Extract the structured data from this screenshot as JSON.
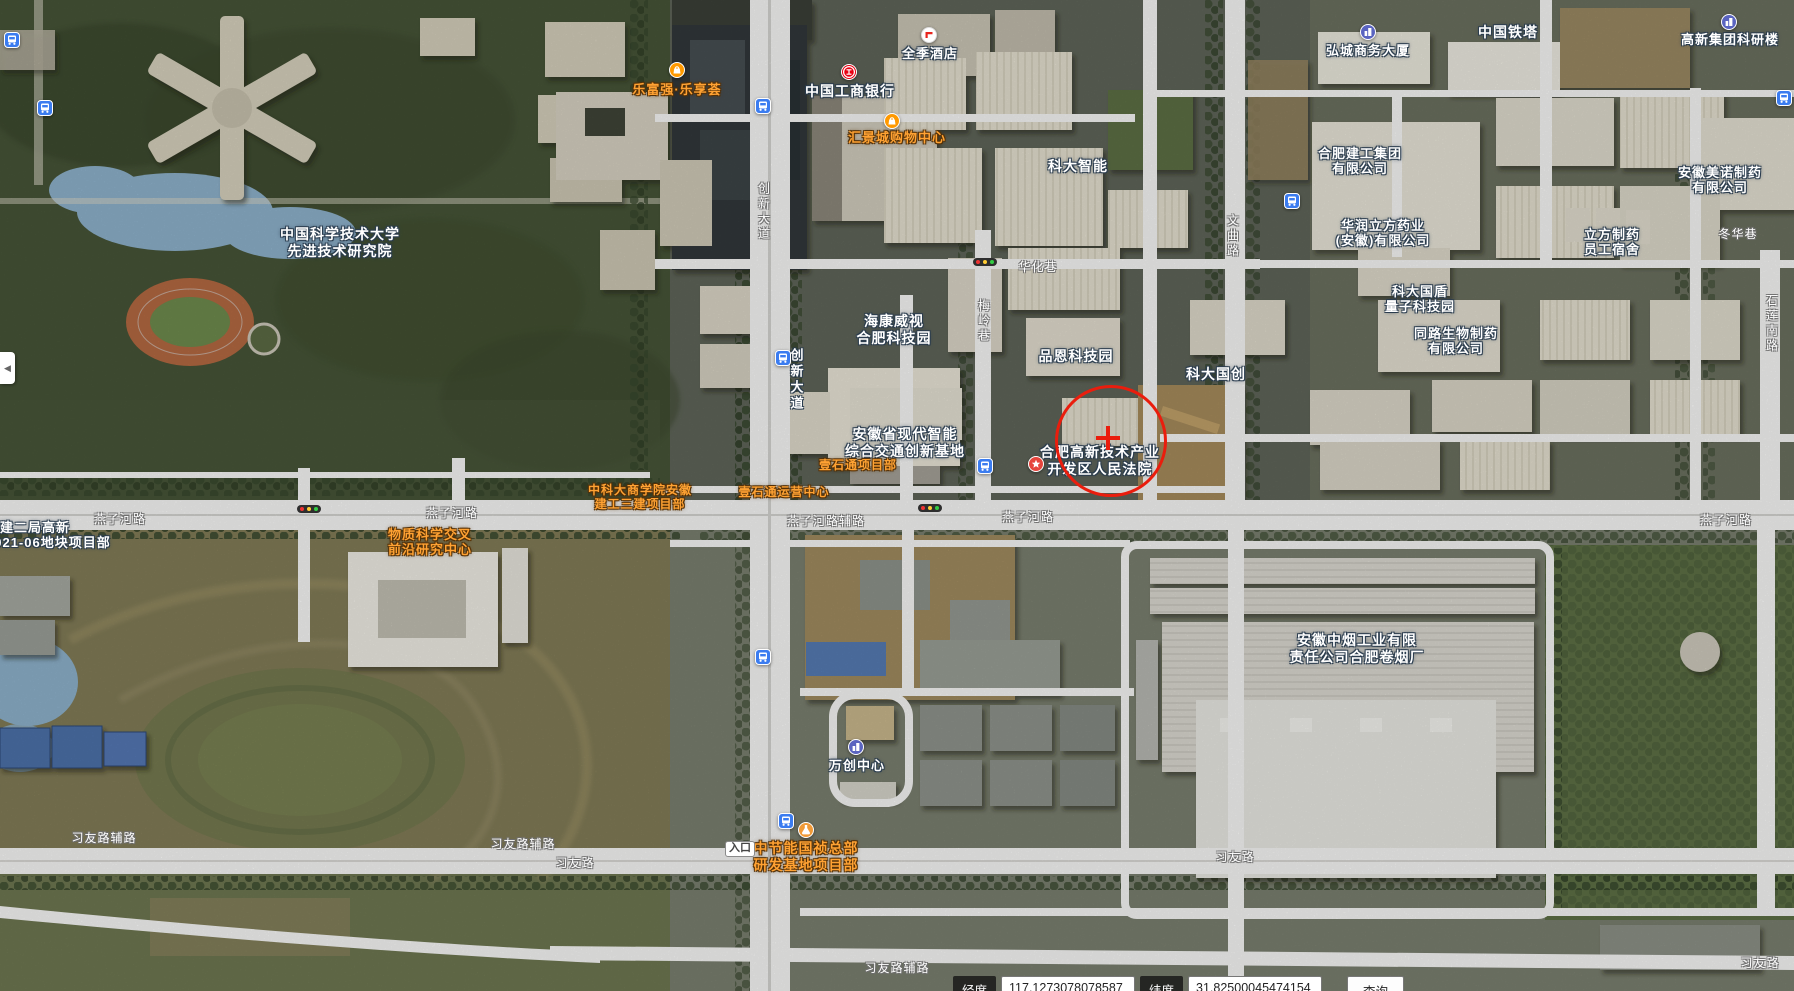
{
  "map": {
    "marker": {
      "x": 1108,
      "y": 438,
      "r": 53,
      "color": "#ea1d0d",
      "cross_len": 24,
      "cross_thick": 4
    },
    "poi_labels": [
      {
        "id": "ustc",
        "lines": [
          "中国科学技术大学",
          "先进技术研究院"
        ],
        "x": 340,
        "y": 226,
        "color": "white",
        "size": 14
      },
      {
        "id": "keda-zhineng",
        "lines": [
          "科大智能"
        ],
        "x": 1078,
        "y": 158,
        "color": "white",
        "size": 14
      },
      {
        "id": "hikvision",
        "lines": [
          "海康威视",
          "合肥科技园"
        ],
        "x": 894,
        "y": 313,
        "color": "white",
        "size": 14
      },
      {
        "id": "pinen",
        "lines": [
          "品恩科技园"
        ],
        "x": 1076,
        "y": 348,
        "color": "white",
        "size": 14
      },
      {
        "id": "keda-guochuang",
        "lines": [
          "科大国创"
        ],
        "x": 1216,
        "y": 366,
        "color": "white",
        "size": 14
      },
      {
        "id": "guodun",
        "lines": [
          "科大国盾",
          "量子科技园"
        ],
        "x": 1420,
        "y": 284,
        "color": "white",
        "size": 13
      },
      {
        "id": "tonglu",
        "lines": [
          "同路生物制药",
          "有限公司"
        ],
        "x": 1456,
        "y": 326,
        "color": "white",
        "size": 13
      },
      {
        "id": "jiaotong-jidi",
        "lines": [
          "安徽省现代智能",
          "综合交通创新基地"
        ],
        "x": 905,
        "y": 426,
        "color": "white",
        "size": 14
      },
      {
        "id": "court",
        "lines": [
          "合肥高新技术产业",
          "开发区人民法院"
        ],
        "x": 1100,
        "y": 444,
        "color": "white",
        "size": 14,
        "icon": {
          "type": "star-icon",
          "x": 1036,
          "y": 464
        }
      },
      {
        "id": "hotel",
        "lines": [
          "全季酒店"
        ],
        "x": 930,
        "y": 46,
        "color": "white",
        "size": 13,
        "icon": {
          "type": "hotel-icon",
          "x": 929,
          "y": 35
        }
      },
      {
        "id": "icbc",
        "lines": [
          "中国工商银行"
        ],
        "x": 850,
        "y": 83,
        "color": "white",
        "size": 14,
        "icon": {
          "type": "bank-icon",
          "x": 849,
          "y": 72
        }
      },
      {
        "id": "huijingcheng",
        "lines": [
          "汇景城购物中心"
        ],
        "x": 897,
        "y": 130,
        "color": "orange",
        "size": 13,
        "icon": {
          "type": "shopping-icon",
          "x": 892,
          "y": 121
        }
      },
      {
        "id": "lefuqiang",
        "lines": [
          "乐富强·乐享荟"
        ],
        "x": 677,
        "y": 82,
        "color": "orange",
        "size": 13,
        "icon": {
          "type": "shopping-icon",
          "x": 677,
          "y": 70
        }
      },
      {
        "id": "hongcheng",
        "lines": [
          "弘城商务大厦"
        ],
        "x": 1368,
        "y": 43,
        "color": "white",
        "size": 13,
        "icon": {
          "type": "building-icon",
          "x": 1368,
          "y": 32
        }
      },
      {
        "id": "tieta",
        "lines": [
          "中国铁塔"
        ],
        "x": 1508,
        "y": 24,
        "color": "white",
        "size": 14
      },
      {
        "id": "gaoxin-keyanlou",
        "lines": [
          "高新集团科研楼"
        ],
        "x": 1730,
        "y": 32,
        "color": "white",
        "size": 13,
        "icon": {
          "type": "building-icon",
          "x": 1729,
          "y": 22
        }
      },
      {
        "id": "jiangong",
        "lines": [
          "合肥建工集团",
          "有限公司"
        ],
        "x": 1360,
        "y": 146,
        "color": "white",
        "size": 13
      },
      {
        "id": "huarun",
        "lines": [
          "华润立方药业",
          "(安徽)有限公司"
        ],
        "x": 1383,
        "y": 218,
        "color": "white",
        "size": 13
      },
      {
        "id": "lifang-sushe",
        "lines": [
          "立方制药",
          "员工宿舍"
        ],
        "x": 1612,
        "y": 227,
        "color": "white",
        "size": 13
      },
      {
        "id": "meinuo",
        "lines": [
          "安徽美诺制药",
          "有限公司"
        ],
        "x": 1720,
        "y": 165,
        "color": "white",
        "size": 13
      },
      {
        "id": "zhongyan",
        "lines": [
          "安徽中烟工业有限",
          "责任公司合肥卷烟厂"
        ],
        "x": 1357,
        "y": 632,
        "color": "white",
        "size": 14
      },
      {
        "id": "wanchuang",
        "lines": [
          "万创中心"
        ],
        "x": 857,
        "y": 758,
        "color": "white",
        "size": 13,
        "icon": {
          "type": "building-icon",
          "x": 856,
          "y": 747
        }
      },
      {
        "id": "zhongjieneng",
        "lines": [
          "中节能国祯总部",
          "研发基地项目部"
        ],
        "x": 806,
        "y": 840,
        "color": "orange",
        "size": 14,
        "icon": {
          "type": "flask-icon",
          "x": 806,
          "y": 830
        }
      },
      {
        "id": "wuzhi-kexue",
        "lines": [
          "物质科学交叉",
          "前沿研究中心"
        ],
        "x": 430,
        "y": 527,
        "color": "orange",
        "size": 13
      },
      {
        "id": "shangxueyuan",
        "lines": [
          "中科大商学院安徽",
          "建工三建项目部"
        ],
        "x": 640,
        "y": 483,
        "color": "orange",
        "size": 12
      },
      {
        "id": "yishitong-xiangmubu",
        "lines": [
          "壹石通项目部"
        ],
        "x": 858,
        "y": 458,
        "color": "orange",
        "size": 12
      },
      {
        "id": "yishitong-yunying",
        "lines": [
          "壹石通运营中心"
        ],
        "x": 784,
        "y": 485,
        "color": "orange",
        "size": 12
      },
      {
        "id": "zhongjian-erju",
        "lines": [
          "中建二局高新",
          "2021-06地块项目部"
        ],
        "x": -14,
        "y": 520,
        "color": "white",
        "size": 13,
        "align": "left"
      },
      {
        "id": "edge-partial",
        "lines": [
          "公司",
          "目部"
        ],
        "x": -30,
        "y": 768,
        "color": "white",
        "size": 13,
        "align": "left"
      }
    ],
    "station_labels": [
      {
        "id": "chuangxin-dadao-stop",
        "text": "创新大道",
        "x": 796,
        "y": 348,
        "icon": {
          "type": "bus-icon",
          "x": 783,
          "y": 358
        }
      }
    ],
    "road_labels": [
      {
        "text": "创新大道",
        "x": 764,
        "y": 182,
        "vertical": true
      },
      {
        "text": "梅岭巷",
        "x": 984,
        "y": 299,
        "vertical": true
      },
      {
        "text": "文曲路",
        "x": 1233,
        "y": 214,
        "vertical": true
      },
      {
        "text": "石莲南路",
        "x": 1772,
        "y": 294,
        "vertical": true
      },
      {
        "text": "华化巷",
        "x": 1038,
        "y": 258
      },
      {
        "text": "冬华巷",
        "x": 1738,
        "y": 225
      },
      {
        "text": "燕子河路",
        "x": 120,
        "y": 510
      },
      {
        "text": "燕子河路",
        "x": 452,
        "y": 504
      },
      {
        "text": "燕子河路辅路",
        "x": 826,
        "y": 512
      },
      {
        "text": "燕子河路",
        "x": 1028,
        "y": 508
      },
      {
        "text": "燕子河路",
        "x": 1726,
        "y": 511
      },
      {
        "text": "习友路辅路",
        "x": 104,
        "y": 829
      },
      {
        "text": "习友路辅路",
        "x": 523,
        "y": 835
      },
      {
        "text": "习友路",
        "x": 575,
        "y": 854
      },
      {
        "text": "习友路",
        "x": 1235,
        "y": 848
      },
      {
        "text": "习友路辅路",
        "x": 897,
        "y": 959
      },
      {
        "text": "习友路",
        "x": 1760,
        "y": 954
      }
    ],
    "badges": [
      {
        "text": "入口",
        "x": 740,
        "y": 841
      }
    ],
    "transit_icons": [
      {
        "type": "bus-icon",
        "x": 12,
        "y": 40
      },
      {
        "type": "bus-icon",
        "x": 45,
        "y": 108
      },
      {
        "type": "bus-icon",
        "x": 763,
        "y": 106
      },
      {
        "type": "bus-icon",
        "x": 985,
        "y": 466
      },
      {
        "type": "bus-icon",
        "x": 1292,
        "y": 201
      },
      {
        "type": "bus-icon",
        "x": 1784,
        "y": 98
      },
      {
        "type": "bus-icon",
        "x": 763,
        "y": 657
      },
      {
        "type": "bus-icon",
        "x": 786,
        "y": 821
      }
    ],
    "traffic_lights": [
      {
        "x": 985,
        "y": 262
      },
      {
        "x": 309,
        "y": 509
      },
      {
        "x": 930,
        "y": 508
      }
    ]
  },
  "controls": {
    "collapse_arrow": "◀"
  },
  "statusbar": {
    "lng_label": "经度",
    "lng_value": "117.1273078078587",
    "lat_label": "纬度",
    "lat_value": "31.82500045474154",
    "query_label": "查询"
  }
}
